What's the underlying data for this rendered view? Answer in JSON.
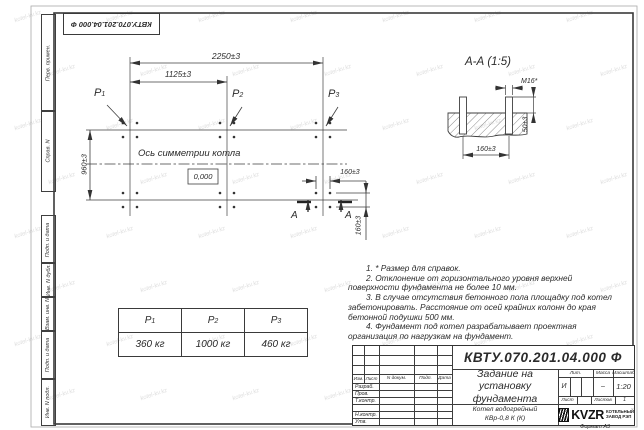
{
  "watermark": {
    "text": "kotel-kv.kz"
  },
  "stamp": {
    "doc_number": "КВТУ.070.201.04.000 Ф"
  },
  "margin_labels": [
    "Перв. примен.",
    "Справ. N",
    "Подп. и дата",
    "Инв. N дубл.",
    "Взам. инв. N",
    "Подп. и дата",
    "Инв. N подл."
  ],
  "plan": {
    "dim_width_total": "2250±3",
    "dim_width_half": "1125±3",
    "dim_depth": "960±3",
    "dim_bolt_x": "160±3",
    "dim_bolt_y": "160±3",
    "axis_caption": "Ось симметрии котла",
    "level_mark": "0,000",
    "loads": [
      {
        "base": "P",
        "sub": "1"
      },
      {
        "base": "P",
        "sub": "2"
      },
      {
        "base": "P",
        "sub": "3"
      }
    ],
    "section_letter_left": "А",
    "section_letter_right": "А"
  },
  "section": {
    "title": "А-А (1:5)",
    "bolt_thread": "M16*",
    "dim_spacing": "160±3",
    "dim_height": "50±3"
  },
  "notes": {
    "items": [
      "1. * Размер для справок.",
      "2. Отклонение от горизонтального уровня верхней поверхности фундамента не более 10 мм.",
      "3. В случае отсутствия бетонного пола площадку под котел забетонировать. Расстояние от осей крайних колонн до края бетонной подушки 500 мм.",
      "4. Фундамент под котел разрабатывает проектная организация по нагрузкам на фундамент."
    ]
  },
  "load_table": {
    "headers": [
      {
        "base": "P",
        "sub": "1"
      },
      {
        "base": "P",
        "sub": "2"
      },
      {
        "base": "P",
        "sub": "3"
      }
    ],
    "values": [
      "360 кг",
      "1000 кг",
      "460 кг"
    ]
  },
  "title_block": {
    "doc_number": "КВТУ.070.201.04.000 Ф",
    "title": "Задание на установку фундамента",
    "product_line1": "Котел водогрейный",
    "product_line2": "КВр-0,8 К (К)",
    "header_cols": [
      "Изм.",
      "Лист",
      "N докум.",
      "Подп.",
      "Дата"
    ],
    "sign_rows": [
      "Разраб.",
      "Пров.",
      "Т.контр.",
      "Н.контр.",
      "Утв."
    ],
    "lit_label": "Лит.",
    "mass_label": "Масса",
    "scale_label": "Масштаб",
    "lit_value": "И",
    "mass_value": "–",
    "scale_value": "1:20",
    "sheet_label": "Лист",
    "sheets_label": "Листов",
    "sheets_value": "1",
    "logo_text": "KVZR",
    "logo_caption_line1": "КОТЕЛЬНЫЙ",
    "logo_caption_line2": "ЗАВОД РЭП",
    "format_note": "Формат А3"
  }
}
